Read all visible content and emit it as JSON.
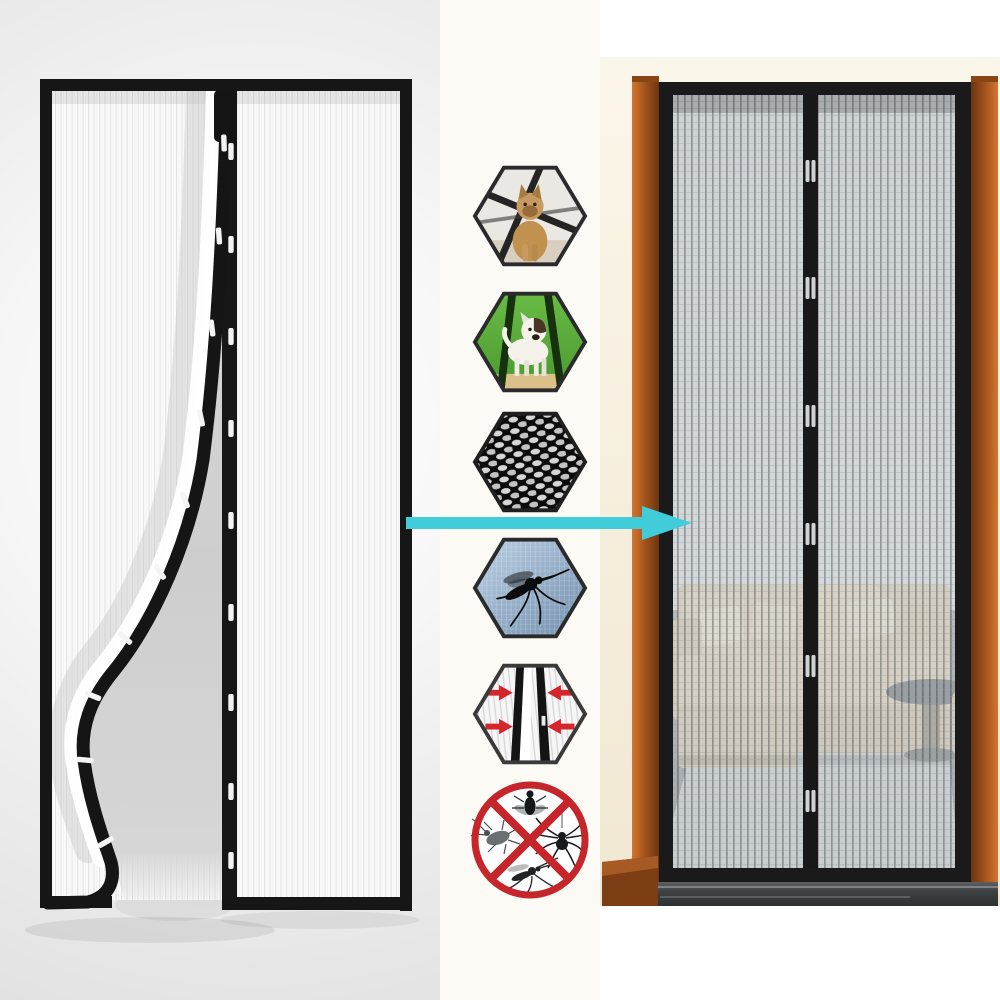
{
  "meta": {
    "title": "Magnetic mesh screen door product image",
    "visible_text": "none"
  },
  "colors": {
    "accent_arrow": "#41ccd9",
    "frame_black": "#1a1a1a",
    "wood_brown": "#a0521c",
    "prohibition_red": "#c4262c",
    "magnet_arrow_red": "#d5262b",
    "grass_green": "#55a636",
    "mosquito_panel_blue": "#8fa9c3",
    "sofa_beige": "#d2c5af",
    "mesh_gray": "#d8dbde",
    "background_cream": "#f6efdd"
  },
  "sections": {
    "left_product_shot": {
      "label": "Magnetic screen door render with left panel peeled open showing magnetic seam"
    },
    "installed_photo": {
      "label": "Magnetic screen door installed in a wooden door frame with a living room behind the mesh"
    },
    "transition_arrow": {
      "label": "Arrow pointing from product render to installed view",
      "direction": "right"
    }
  },
  "feature_icons": [
    {
      "id": "cat",
      "label": "Pet friendly - cat walks through"
    },
    {
      "id": "dog",
      "label": "Pet friendly - dog walks through"
    },
    {
      "id": "mesh",
      "label": "Dense woven mesh close-up"
    },
    {
      "id": "mosquito",
      "label": "Blocks mosquitoes and flying insects"
    },
    {
      "id": "magnetic-close",
      "label": "Magnetic strips snap closed automatically"
    },
    {
      "id": "no-insects",
      "label": "Keeps out flies, roaches, spiders and mosquitoes"
    }
  ]
}
